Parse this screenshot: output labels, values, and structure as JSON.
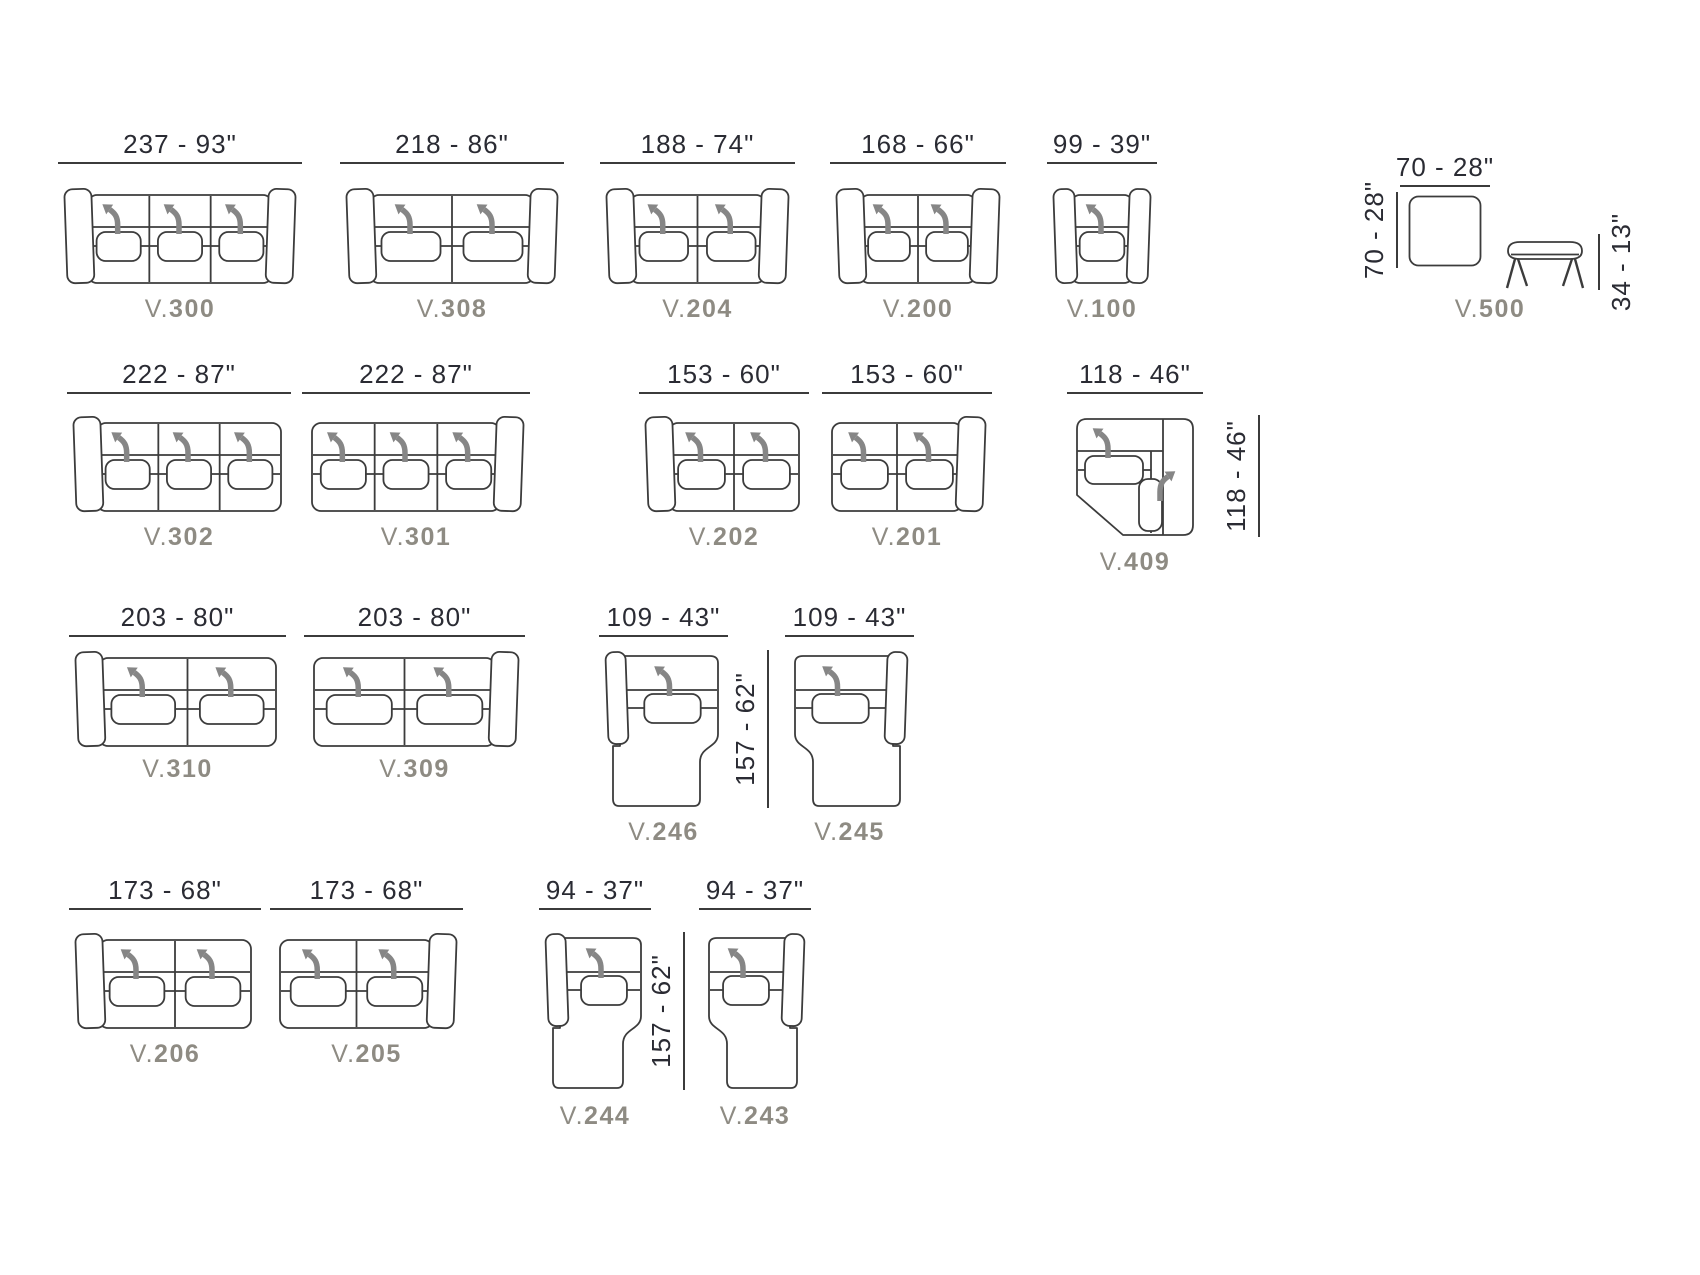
{
  "colors": {
    "line": "#3c3c3c",
    "dim_text": "#2a2b33",
    "label_text": "#8e8b83",
    "arrow": "#868686",
    "background": "#ffffff"
  },
  "modules": [
    {
      "id": "v300",
      "type": "sofa",
      "seats": 3,
      "arm": "both",
      "code": {
        "prefix": "V.",
        "number": "300"
      },
      "width_dim": "237 - 93\"",
      "box": {
        "x": 66,
        "y": 187,
        "w": 228,
        "h": 98
      },
      "dim_line_y": 162,
      "label_y": 295
    },
    {
      "id": "v308",
      "type": "sofa",
      "seats": 2,
      "arm": "both",
      "code": {
        "prefix": "V.",
        "number": "308"
      },
      "width_dim": "218 - 86\"",
      "box": {
        "x": 348,
        "y": 187,
        "w": 208,
        "h": 98
      },
      "dim_line_y": 162,
      "label_y": 295
    },
    {
      "id": "v204",
      "type": "sofa",
      "seats": 2,
      "arm": "both",
      "code": {
        "prefix": "V.",
        "number": "204"
      },
      "width_dim": "188 - 74\"",
      "box": {
        "x": 608,
        "y": 187,
        "w": 179,
        "h": 98
      },
      "dim_line_y": 162,
      "label_y": 295
    },
    {
      "id": "v200",
      "type": "sofa",
      "seats": 2,
      "arm": "both",
      "code": {
        "prefix": "V.",
        "number": "200"
      },
      "width_dim": "168 - 66\"",
      "box": {
        "x": 838,
        "y": 187,
        "w": 160,
        "h": 98
      },
      "dim_line_y": 162,
      "label_y": 295
    },
    {
      "id": "v100",
      "type": "sofa",
      "seats": 1,
      "arm": "both",
      "code": {
        "prefix": "V.",
        "number": "100"
      },
      "width_dim": "99 - 39\"",
      "box": {
        "x": 1055,
        "y": 187,
        "w": 94,
        "h": 98
      },
      "dim_line_y": 162,
      "label_y": 295
    },
    {
      "id": "v500",
      "type": "ottoman-bench",
      "code": {
        "prefix": "V.",
        "number": "500"
      },
      "top_dim": {
        "text": "70 - 28\"",
        "x": 1400,
        "w": 90,
        "line_y": 185
      },
      "square": {
        "x": 1408,
        "y": 195,
        "w": 74,
        "h": 72
      },
      "bench": {
        "x": 1504,
        "y": 240,
        "w": 82,
        "h": 50
      },
      "label_center_x": 1490,
      "label_y": 295
    },
    {
      "id": "v302",
      "type": "sofa",
      "seats": 3,
      "arm": "left",
      "code": {
        "prefix": "V.",
        "number": "302"
      },
      "width_dim": "222 - 87\"",
      "box": {
        "x": 75,
        "y": 415,
        "w": 208,
        "h": 98
      },
      "dim_line_y": 392,
      "label_y": 523
    },
    {
      "id": "v301",
      "type": "sofa",
      "seats": 3,
      "arm": "right",
      "code": {
        "prefix": "V.",
        "number": "301"
      },
      "width_dim": "222 - 87\"",
      "box": {
        "x": 310,
        "y": 415,
        "w": 212,
        "h": 98
      },
      "dim_line_y": 392,
      "label_y": 523
    },
    {
      "id": "v202",
      "type": "sofa",
      "seats": 2,
      "arm": "left",
      "code": {
        "prefix": "V.",
        "number": "202"
      },
      "width_dim": "153 - 60\"",
      "box": {
        "x": 647,
        "y": 415,
        "w": 154,
        "h": 98
      },
      "dim_line_y": 392,
      "label_y": 523
    },
    {
      "id": "v201",
      "type": "sofa",
      "seats": 2,
      "arm": "right",
      "code": {
        "prefix": "V.",
        "number": "201"
      },
      "width_dim": "153 - 60\"",
      "box": {
        "x": 830,
        "y": 415,
        "w": 154,
        "h": 98
      },
      "dim_line_y": 392,
      "label_y": 523
    },
    {
      "id": "v409",
      "type": "corner",
      "code": {
        "prefix": "V.",
        "number": "409"
      },
      "width_dim": "118 - 46\"",
      "box": {
        "x": 1075,
        "y": 415,
        "w": 120,
        "h": 122
      },
      "dim_line_y": 392,
      "label_y": 548,
      "label_center_x": 1135
    },
    {
      "id": "v310",
      "type": "sofa",
      "seats": 2,
      "arm": "left",
      "code": {
        "prefix": "V.",
        "number": "310"
      },
      "width_dim": "203 - 80\"",
      "box": {
        "x": 77,
        "y": 650,
        "w": 201,
        "h": 98
      },
      "dim_line_y": 635,
      "label_y": 755
    },
    {
      "id": "v309",
      "type": "sofa",
      "seats": 2,
      "arm": "right",
      "code": {
        "prefix": "V.",
        "number": "309"
      },
      "width_dim": "203 - 80\"",
      "box": {
        "x": 312,
        "y": 650,
        "w": 205,
        "h": 98
      },
      "dim_line_y": 635,
      "label_y": 755
    },
    {
      "id": "v246",
      "type": "chaise",
      "arm": "left",
      "code": {
        "prefix": "V.",
        "number": "246"
      },
      "width_dim": "109 - 43\"",
      "box": {
        "x": 607,
        "y": 650,
        "w": 113,
        "h": 158
      },
      "dim_line_y": 635,
      "label_y": 818
    },
    {
      "id": "v245",
      "type": "chaise",
      "arm": "right",
      "code": {
        "prefix": "V.",
        "number": "245"
      },
      "width_dim": "109 - 43\"",
      "box": {
        "x": 793,
        "y": 650,
        "w": 113,
        "h": 158
      },
      "dim_line_y": 635,
      "label_y": 818
    },
    {
      "id": "v206",
      "type": "sofa",
      "seats": 2,
      "arm": "left",
      "code": {
        "prefix": "V.",
        "number": "206"
      },
      "width_dim": "173 - 68\"",
      "box": {
        "x": 77,
        "y": 932,
        "w": 176,
        "h": 98
      },
      "dim_line_y": 908,
      "label_y": 1040
    },
    {
      "id": "v205",
      "type": "sofa",
      "seats": 2,
      "arm": "right",
      "code": {
        "prefix": "V.",
        "number": "205"
      },
      "width_dim": "173 - 68\"",
      "box": {
        "x": 278,
        "y": 932,
        "w": 177,
        "h": 98
      },
      "dim_line_y": 908,
      "label_y": 1040
    },
    {
      "id": "v244",
      "type": "chaise",
      "arm": "left",
      "code": {
        "prefix": "V.",
        "number": "244"
      },
      "width_dim": "94 - 37\"",
      "box": {
        "x": 547,
        "y": 932,
        "w": 96,
        "h": 158
      },
      "dim_line_y": 908,
      "label_y": 1102
    },
    {
      "id": "v243",
      "type": "chaise",
      "arm": "right",
      "code": {
        "prefix": "V.",
        "number": "243"
      },
      "width_dim": "94 - 37\"",
      "box": {
        "x": 707,
        "y": 932,
        "w": 96,
        "h": 158
      },
      "dim_line_y": 908,
      "label_y": 1102
    }
  ],
  "vertical_dims": [
    {
      "name": "ottoman-depth-dimension",
      "text": "70 - 28\"",
      "line_x": 1396,
      "y": 192,
      "h": 76,
      "side": "left"
    },
    {
      "name": "bench-height-dimension",
      "text": "34 - 13\"",
      "line_x": 1598,
      "y": 234,
      "h": 56,
      "side": "right"
    },
    {
      "name": "corner-depth-dimension",
      "text": "118 - 46\"",
      "line_x": 1258,
      "y": 415,
      "h": 122,
      "side": "left"
    },
    {
      "name": "chaise-depth-dimension-row3",
      "text": "157 - 62\"",
      "line_x": 767,
      "y": 650,
      "h": 158,
      "side": "left"
    },
    {
      "name": "chaise-depth-dimension-row4",
      "text": "157 - 62\"",
      "line_x": 683,
      "y": 932,
      "h": 158,
      "side": "left"
    }
  ]
}
